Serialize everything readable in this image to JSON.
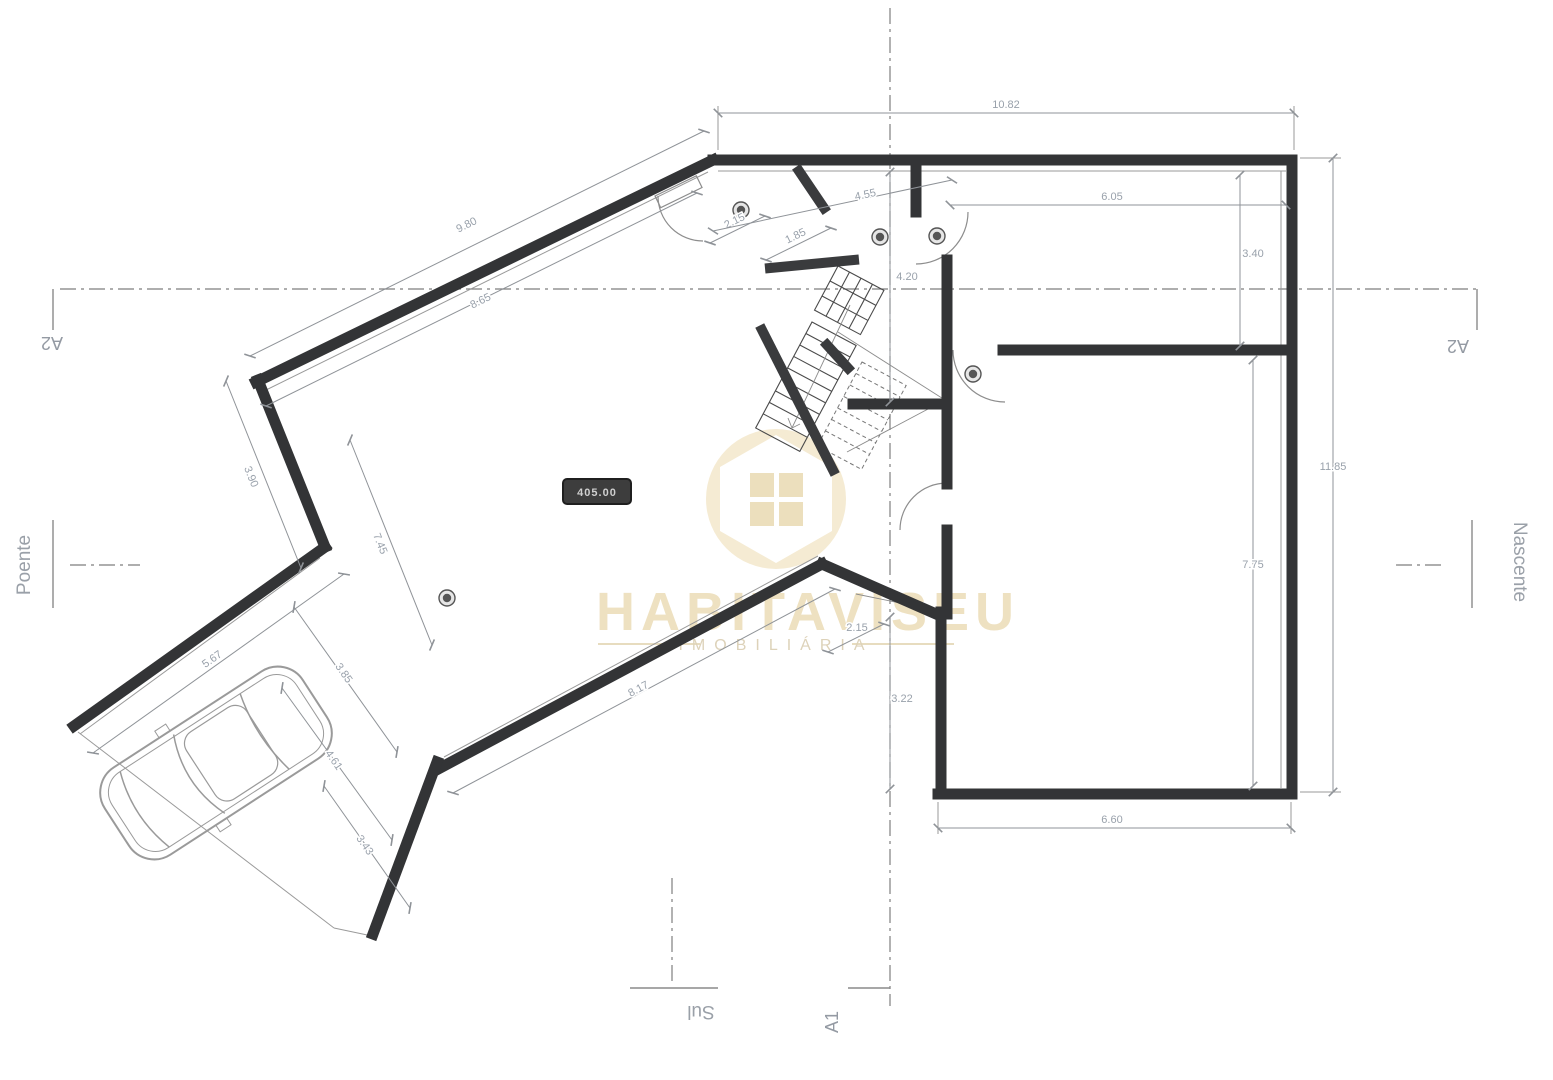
{
  "watermark": {
    "brand": "HABITAVISEU",
    "tagline": "IMOBILIÁRIA"
  },
  "elevation_badge": {
    "value": "405.00"
  },
  "axes": {
    "a1": "A1",
    "a2_left": "A2",
    "a2_right": "A2",
    "west": "Poente",
    "east": "Nascente",
    "south": "Sul"
  },
  "dimensions": [
    {
      "id": "top-width",
      "value": "10.82",
      "x1": 718,
      "y1": 113,
      "x2": 1294,
      "y2": 113,
      "lx": 1006,
      "ly": 108,
      "rot": 0
    },
    {
      "id": "upper-diagonal",
      "value": "9.80",
      "x1": 704,
      "y1": 131,
      "x2": 250,
      "y2": 356,
      "lx": 468,
      "ly": 228,
      "rot": -26
    },
    {
      "id": "inner-diagonal",
      "value": "8.65",
      "x1": 697,
      "y1": 193,
      "x2": 266,
      "y2": 406,
      "lx": 482,
      "ly": 304,
      "rot": -26
    },
    {
      "id": "room-ne-width",
      "value": "6.05",
      "x1": 950,
      "y1": 205,
      "x2": 1286,
      "y2": 205,
      "lx": 1112,
      "ly": 200,
      "rot": 0
    },
    {
      "id": "room-ne-height",
      "value": "3.40",
      "x1": 1240,
      "y1": 175,
      "x2": 1240,
      "y2": 346,
      "lx": 1253,
      "ly": 257,
      "rot": 0
    },
    {
      "id": "hall-height",
      "value": "4.20",
      "x1": 890,
      "y1": 172,
      "x2": 890,
      "y2": 402,
      "lx": 907,
      "ly": 280,
      "rot": 0
    },
    {
      "id": "right-total",
      "value": "11.85",
      "x1": 1333,
      "y1": 158,
      "x2": 1333,
      "y2": 792,
      "lx": 1333,
      "ly": 470,
      "rot": 0
    },
    {
      "id": "room-e-height",
      "value": "7.75",
      "x1": 1253,
      "y1": 360,
      "x2": 1253,
      "y2": 786,
      "lx": 1253,
      "ly": 568,
      "rot": 0
    },
    {
      "id": "bottom-width",
      "value": "6.60",
      "x1": 938,
      "y1": 828,
      "x2": 1291,
      "y2": 828,
      "lx": 1112,
      "ly": 823,
      "rot": 0
    },
    {
      "id": "south-offset",
      "value": "3.22",
      "x1": 890,
      "y1": 617,
      "x2": 890,
      "y2": 789,
      "lx": 902,
      "ly": 702,
      "rot": 0
    },
    {
      "id": "entry-a",
      "value": "2.15",
      "x1": 710,
      "y1": 243,
      "x2": 765,
      "y2": 216,
      "lx": 736,
      "ly": 224,
      "rot": -26
    },
    {
      "id": "entry-b",
      "value": "1.85",
      "x1": 766,
      "y1": 260,
      "x2": 831,
      "y2": 228,
      "lx": 797,
      "ly": 239,
      "rot": -26
    },
    {
      "id": "entry-c",
      "value": "4.55",
      "x1": 713,
      "y1": 231,
      "x2": 952,
      "y2": 180,
      "lx": 866,
      "ly": 198,
      "rot": -12
    },
    {
      "id": "apex-offset",
      "value": "2.15",
      "x1": 828,
      "y1": 652,
      "x2": 884,
      "y2": 624,
      "lx": 857,
      "ly": 631,
      "rot": 0
    },
    {
      "id": "left-wall",
      "value": "3.90",
      "x1": 226,
      "y1": 381,
      "x2": 301,
      "y2": 568,
      "lx": 248,
      "ly": 478,
      "rot": 68
    },
    {
      "id": "living-depth",
      "value": "7.45",
      "x1": 350,
      "y1": 440,
      "x2": 432,
      "y2": 645,
      "lx": 377,
      "ly": 545,
      "rot": 68
    },
    {
      "id": "carport-top",
      "value": "5.67",
      "x1": 93,
      "y1": 753,
      "x2": 344,
      "y2": 574,
      "lx": 214,
      "ly": 662,
      "rot": -35
    },
    {
      "id": "carport-a",
      "value": "3.85",
      "x1": 294,
      "y1": 607,
      "x2": 397,
      "y2": 752,
      "lx": 341,
      "ly": 675,
      "rot": 55
    },
    {
      "id": "carport-b",
      "value": "4.61",
      "x1": 282,
      "y1": 688,
      "x2": 392,
      "y2": 840,
      "lx": 331,
      "ly": 762,
      "rot": 55
    },
    {
      "id": "carport-c",
      "value": "3.43",
      "x1": 324,
      "y1": 786,
      "x2": 410,
      "y2": 908,
      "lx": 362,
      "ly": 847,
      "rot": 55
    },
    {
      "id": "south-wall",
      "value": "8.17",
      "x1": 453,
      "y1": 793,
      "x2": 835,
      "y2": 589,
      "lx": 640,
      "ly": 692,
      "rot": -28
    }
  ]
}
